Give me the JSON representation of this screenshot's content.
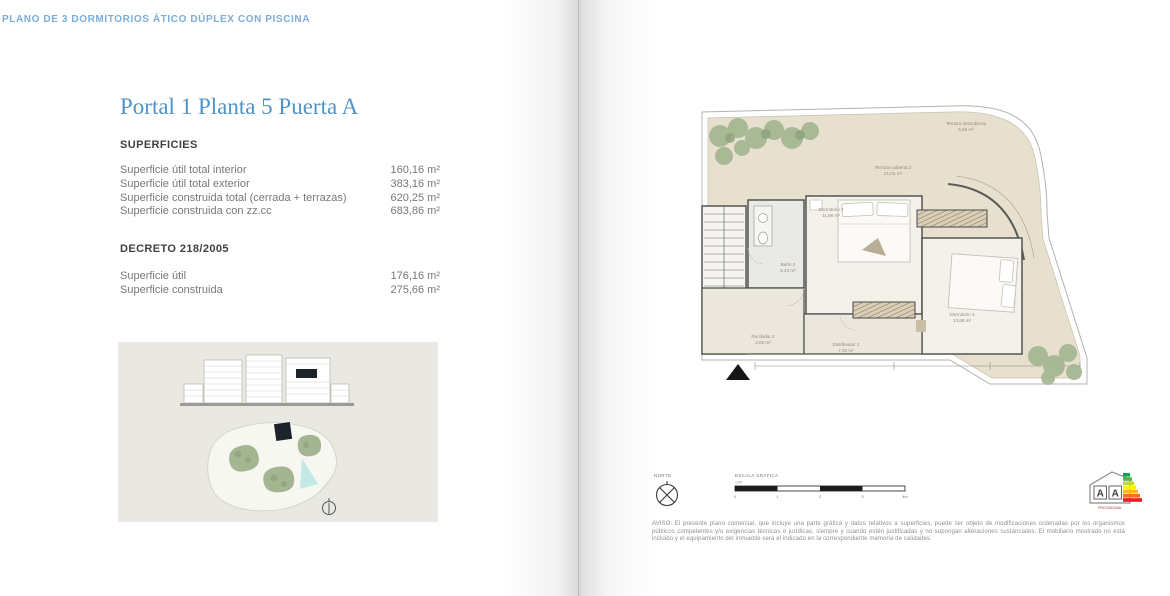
{
  "page": {
    "header": "PLANO DE 3 DORMITORIOS ÁTICO DÚPLEX CON PISCINA",
    "title": "Portal 1 Planta 5 Puerta A"
  },
  "superficies": {
    "heading": "SUPERFICIES",
    "rows": [
      {
        "label": "Superficie útil total interior",
        "value": "160,16 m²"
      },
      {
        "label": "Superficie útil total exterior",
        "value": "383,16 m²"
      },
      {
        "label": "Superficie construida total (cerrada + terrazas)",
        "value": "620,25 m²"
      },
      {
        "label": "Superficie construida con zz.cc",
        "value": "683,86 m²"
      }
    ]
  },
  "decreto": {
    "heading": "DECRETO 218/2005",
    "rows": [
      {
        "label": "Superficie útil",
        "value": "176,16 m²"
      },
      {
        "label": "Superficie construida",
        "value": "275,66 m²"
      }
    ]
  },
  "floorplan": {
    "labels": [
      {
        "name": "Terraza descubierta",
        "area": "5,66 m²"
      },
      {
        "name": "Terraza cubierta 2",
        "area": "21,04 m²"
      },
      {
        "name": "Dormitorio 2",
        "area": "11,98 m²"
      },
      {
        "name": "Baño 2",
        "area": "5,24 m²"
      },
      {
        "name": "Recibidor 2",
        "area": "4,05 m²"
      },
      {
        "name": "Distribuidor 2",
        "area": "7,30 m²"
      },
      {
        "name": "Dormitorio 3",
        "area": "13,68 m²"
      }
    ]
  },
  "legend": {
    "north_label": "NORTE",
    "scale_label": "ESCALA GRÁFICA",
    "scale_ratio": "1:50",
    "scale_ticks": [
      "0",
      "1",
      "2",
      "3",
      "4m"
    ]
  },
  "energy": {
    "letters": [
      "A",
      "A"
    ],
    "caption": "PROVISIONAL",
    "colors": [
      "#00a650",
      "#50b848",
      "#bfd730",
      "#fff200",
      "#fdb913",
      "#f37021",
      "#ed1c24"
    ]
  },
  "disclaimer": "AVISO: El presente plano comercial, que incluye una parte gráfica y datos relativos a superficies, puede ser objeto de modificaciones ordenadas por los organismos públicos competentes y/o exigencias técnicas o jurídicas, siempre y cuando estén justificadas y no supongan alteraciones sustanciales. El mobiliario mostrado no está incluido y el equipamiento del inmueble será el indicado en la correspondiente memoria de calidades.",
  "colors": {
    "accent_blue": "#7badd6",
    "title_blue": "#4d93c8",
    "heading_gray": "#414042",
    "body_gray": "#77787b",
    "terrace_beige": "#e7e0ce",
    "room_floor": "#f3f1ea",
    "hall_floor": "#ece7dd",
    "plan_green": "#a3b591",
    "plan_green_dark": "#8ca37c",
    "pool_cyan": "#c2e9e4",
    "keyplan_bg": "#e9e8e2"
  }
}
